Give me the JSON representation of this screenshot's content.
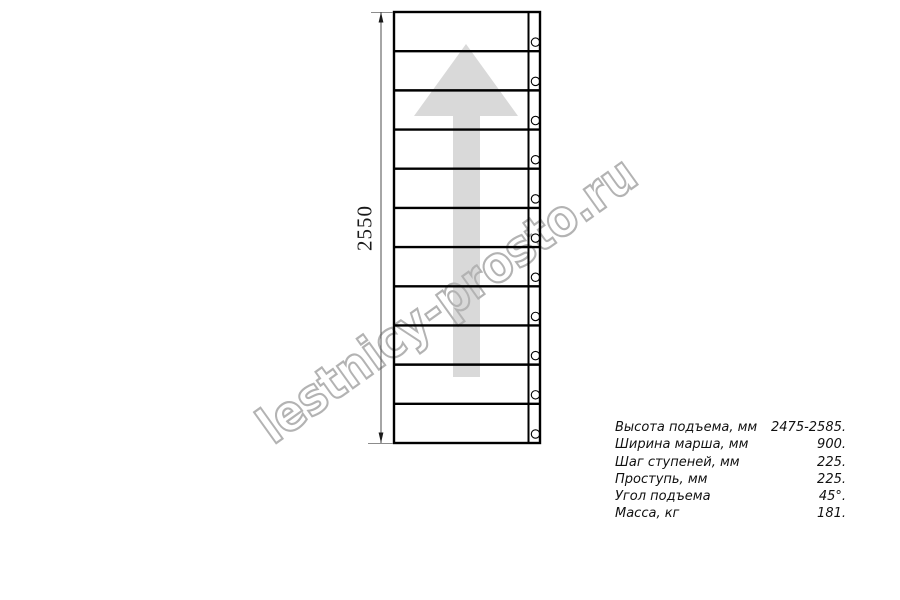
{
  "watermark": {
    "text": "lestnicy-prosto.ru",
    "color": "#b3b3b3"
  },
  "diagram": {
    "type": "staircase-flight-plan-view",
    "dimension_label": "2550",
    "steps": 11,
    "arrow_direction": "up",
    "arrow_color": "#d9d9d9",
    "line_color": "#000000",
    "dimension_line_color": "#4d4d4d",
    "extension_line_color": "#8c8c8c"
  },
  "specs": {
    "rows": [
      {
        "label": "Высота подъема, мм",
        "value": "2475-2585."
      },
      {
        "label": "Ширина марша, мм",
        "value": "900."
      },
      {
        "label": "Шаг ступеней, мм",
        "value": "225."
      },
      {
        "label": "Проступь, мм",
        "value": "225."
      },
      {
        "label": "Угол подъема",
        "value": "45°."
      },
      {
        "label": "Масса, кг",
        "value": "181."
      }
    ]
  }
}
